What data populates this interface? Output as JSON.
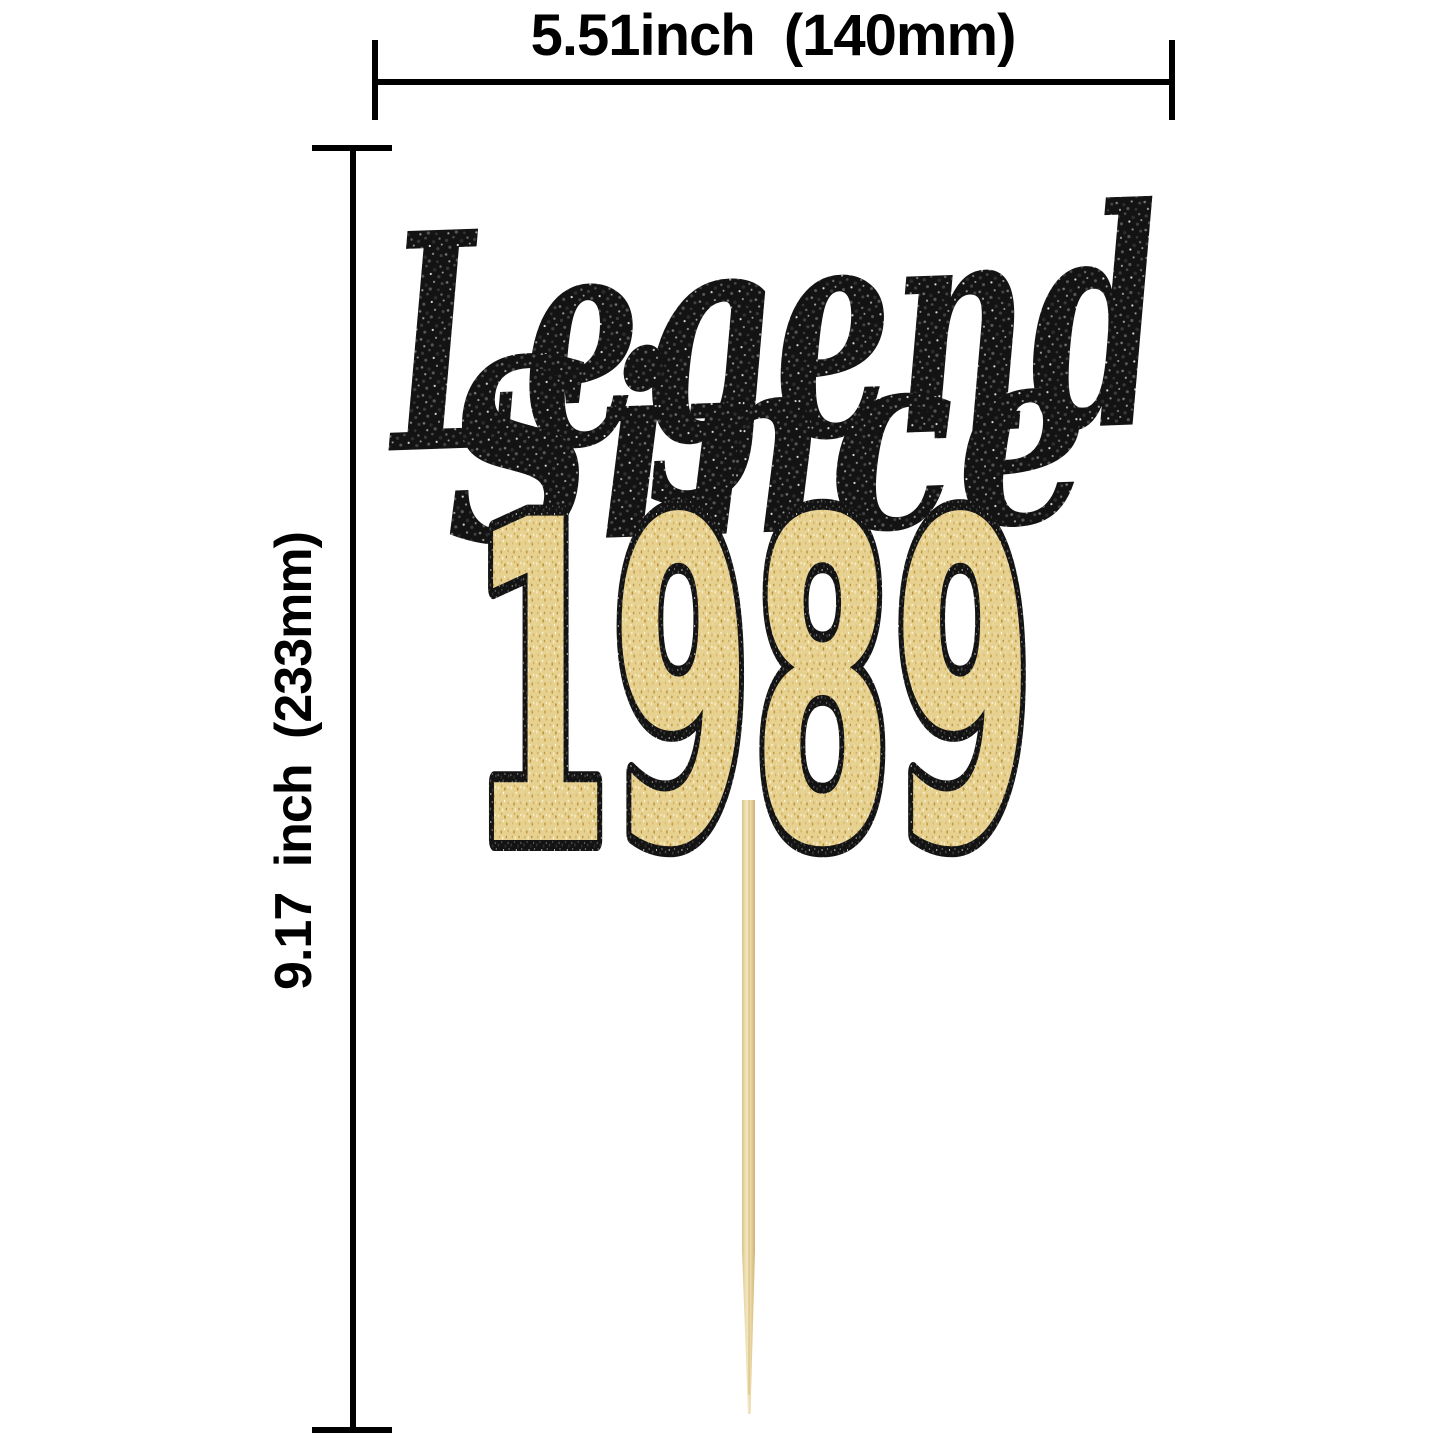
{
  "page": {
    "background": "#ffffff",
    "type": "product-dimension-diagram"
  },
  "dimensions": {
    "width_label": "5.51inch (140mm)",
    "height_label": "9.17 inch (233mm)",
    "line_color": "#000000"
  },
  "topper": {
    "line1": "Legend",
    "line2": "Since",
    "year": "1989",
    "colors": {
      "black_glitter": "#131313",
      "black_glitter_sparkle": "#ffffff",
      "gold_glitter": "#e7d191",
      "gold_glitter_light": "#f6ecc3",
      "gold_glitter_dark": "#b98f33",
      "year_outline": "#0f0f0f",
      "wood_stick": "#e9d8a6"
    }
  }
}
